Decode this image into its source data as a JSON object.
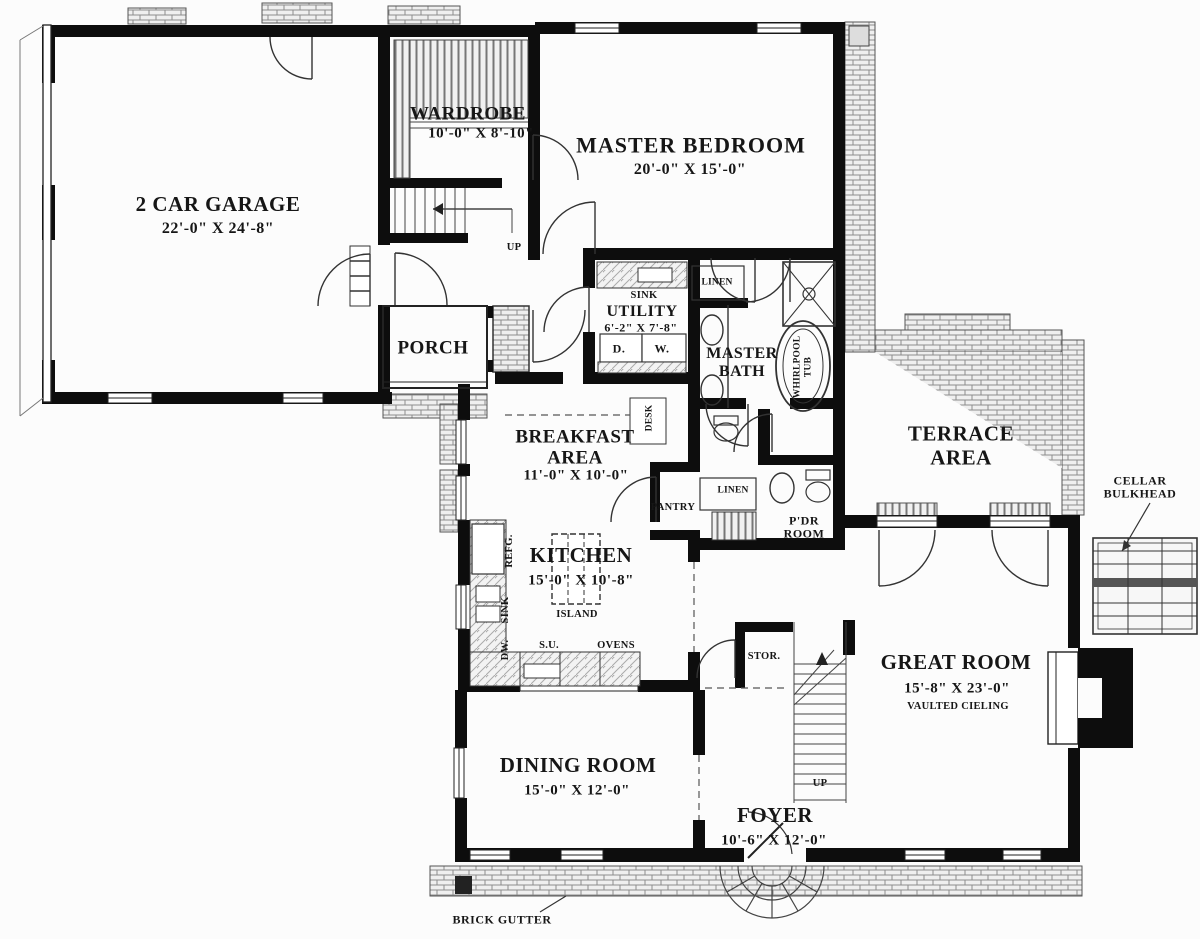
{
  "rooms": {
    "garage": {
      "name": "2 CAR GARAGE",
      "dims": "22'-0\" X 24'-8\""
    },
    "wardrobe": {
      "name": "WARDROBE",
      "dims": "10'-0\" X 8'-10\""
    },
    "master_bedroom": {
      "name": "MASTER BEDROOM",
      "dims": "20'-0\" X 15'-0\""
    },
    "utility": {
      "name": "UTILITY",
      "dims": "6'-2\" X 7'-8\""
    },
    "master_bath": {
      "name": "MASTER\nBATH"
    },
    "porch": {
      "name": "PORCH"
    },
    "breakfast": {
      "name": "BREAKFAST\nAREA",
      "dims": "11'-0\" X 10'-0\""
    },
    "terrace": {
      "name": "TERRACE\nAREA"
    },
    "pdr": {
      "name": "P'DR\nROOM"
    },
    "kitchen": {
      "name": "KITCHEN",
      "dims": "15'-0\" X 10'-8\""
    },
    "great_room": {
      "name": "GREAT ROOM",
      "dims": "15'-8\" X 23'-0\"",
      "note": "VAULTED CIELING"
    },
    "dining": {
      "name": "DINING ROOM",
      "dims": "15'-0\" X 12'-0\""
    },
    "foyer": {
      "name": "FOYER",
      "dims": "10'-6\" X 12'-0\""
    }
  },
  "fixtures": {
    "sink_utility": "SINK",
    "dryer": "D.",
    "washer": "W.",
    "linen_bath": "LINEN",
    "linen_hall": "LINEN",
    "whirlpool": "WHIRLPOOL\nTUB",
    "desk": "DESK",
    "pantry": "PANTRY",
    "island": "ISLAND",
    "refrigerator": "REFG.",
    "sink_kitchen": "SINK",
    "dishwasher": "DW.",
    "serving_unit": "S.U.",
    "ovens": "OVENS",
    "storage": "STOR.",
    "up_back_stairs": "UP",
    "up_main_stairs": "UP"
  },
  "annotations": {
    "cellar_bulkhead": "CELLAR\nBULKHEAD",
    "brick_gutter": "BRICK GUTTER"
  },
  "colors": {
    "wall": "#0d0d0d",
    "paper": "#fcfcfc",
    "line": "#2a2a2a",
    "hatch": "#8c8c8c"
  }
}
